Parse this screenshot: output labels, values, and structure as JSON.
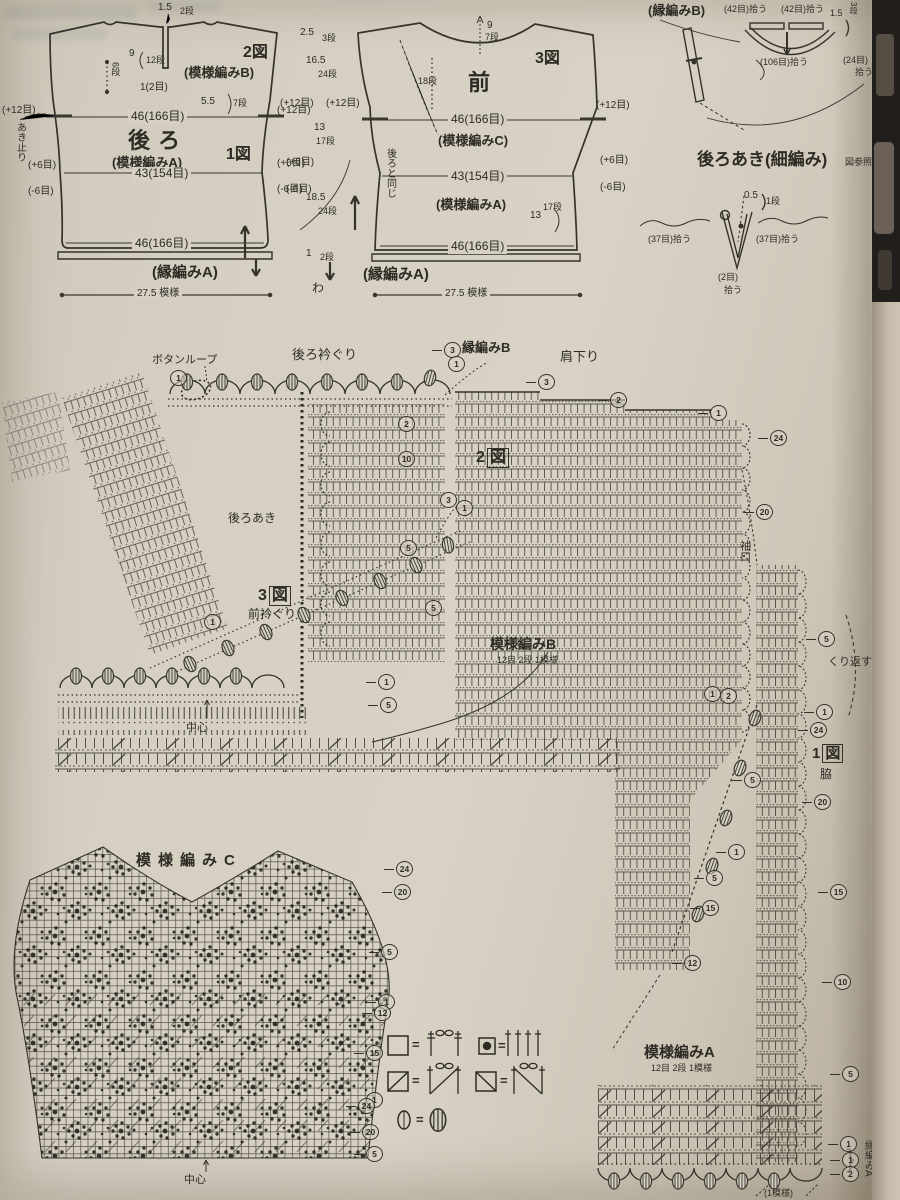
{
  "back": {
    "fig1": "1図",
    "fig2": "2図",
    "title": "後ろ",
    "patA": "(模様編みA)",
    "patB": "(模様編みB)",
    "notch_w": "1.5",
    "notch_r": "2段",
    "d9": "9",
    "d9r": "12段",
    "d6r": "6段",
    "d12m": "1(2目)",
    "d55": "5.5",
    "d55r": "7段",
    "p12l": "(+12目)",
    "p12r": "(+12目)",
    "w_top": "46(166目)",
    "p6l": "(+6目)",
    "p6r": "(+6目)",
    "w_mid": "43(154目)",
    "m6l": "(-6目)",
    "m6r": "(-6目)",
    "w_bot": "46(166目)",
    "edge": "(縁編みA)",
    "motifs": "27.5 模様",
    "akidomari": "あき止り"
  },
  "center": {
    "a": "2.5",
    "ar": "3段",
    "b": "16.5",
    "br": "24段",
    "p12a": "(+12目)",
    "p12b": "(+12目)",
    "c": "13",
    "cr": "17段",
    "p6": "(+6目)",
    "m6": "(-6目)",
    "d": "18.5",
    "dr": "24段",
    "e": "1",
    "er": "2段",
    "wa": "わ"
  },
  "front": {
    "fig": "3図",
    "title": "前",
    "n9": "9",
    "n9r": "7段",
    "d18r": "18段",
    "w_top": "46(166目)",
    "patC": "(模様編みC)",
    "same": "後ろと同じ",
    "w_mid": "43(154目)",
    "patA": "(模様編みA)",
    "d13": "13",
    "d13r": "17段",
    "p12r": "(+12目)",
    "p6r": "(+6目)",
    "m6r": "(-6目)",
    "w_bot": "46(166目)",
    "edge": "(縁編みA)",
    "motifs": "27.5 模様"
  },
  "pickup": {
    "edgeB": "(縁編みB)",
    "pick42l": "(42目)拾う",
    "pick42r": "(42目)拾う",
    "d15": "1.5",
    "d15r": "3段",
    "pick106": "(106目)拾う",
    "pick24": "(24目)",
    "pick24b": "拾う"
  },
  "opening": {
    "title": "後ろあき(細編み)",
    "ref": "図参照",
    "d05": "0.5",
    "d05r": "1段",
    "pick37l": "(37目)拾う",
    "pick37r": "(37目)拾う",
    "pick2": "(2目)",
    "pick2b": "拾う"
  },
  "chart": {
    "button_loop": "ボタンループ",
    "back_neck": "後ろ衿ぐり",
    "edgeB": "縁編みB",
    "shoulder": "肩下り",
    "fig2n": "2",
    "fig2z": "図",
    "back_open": "後ろあき",
    "fig3n": "3",
    "fig3z": "図",
    "front_neck": "前衿ぐり",
    "patB": "模様編みB",
    "patB_sub": "12目 2段 1模様",
    "center": "中心",
    "sleeve": "袖口"
  },
  "side": {
    "fig1n": "1",
    "fig1z": "図",
    "waki": "脇",
    "repeat": "くり返す"
  },
  "patC": {
    "title": "模様編みC",
    "center": "中心"
  },
  "patA": {
    "title": "模様編みA",
    "sub": "12目 2段 1模様",
    "edgeA": "縁編みA",
    "one_motif": "(1模様)",
    "brace": "}"
  },
  "legend": {
    "eq1": "=",
    "eq2": "=",
    "eq3": "=",
    "eq4": "=",
    "eq5": "="
  },
  "markers": {
    "main": [
      "1",
      "3",
      "1",
      "2",
      "10",
      "5",
      "1",
      "3",
      "2",
      "1",
      "24",
      "20",
      "3",
      "1",
      "5",
      "1",
      "5",
      "1",
      "2",
      "5",
      "1",
      "5",
      "15",
      "12"
    ],
    "side": [
      "5",
      "1",
      "24",
      "20",
      "15",
      "10",
      "5",
      "1",
      "1",
      "2"
    ],
    "c": [
      "24",
      "20",
      "5",
      "1",
      "12",
      "15",
      "1",
      "24",
      "20",
      "5"
    ]
  },
  "ink": "#3a372f"
}
